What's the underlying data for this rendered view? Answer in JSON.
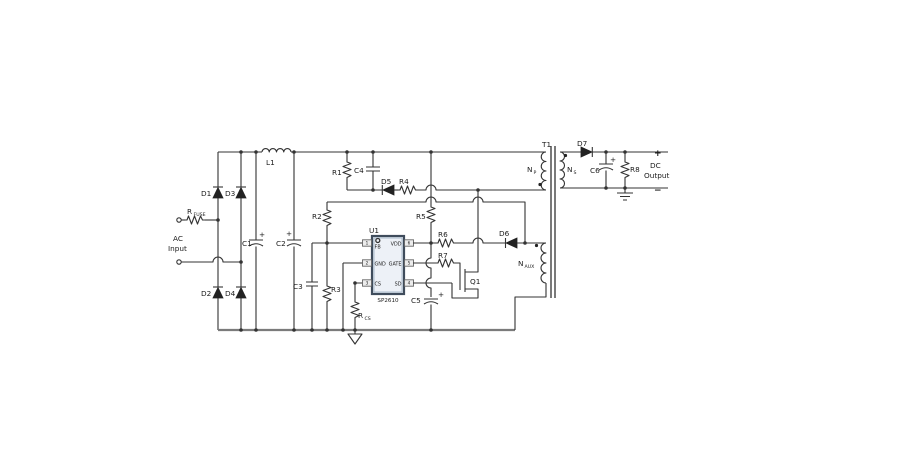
{
  "colors": {
    "wire": "#333333",
    "rail": "#7b7b7b",
    "ic_fill": "#edf1f7",
    "ic_border": "#3f4c5c",
    "pin_fill": "#ececec"
  },
  "schematic": {
    "input": {
      "ac": "AC",
      "input": "Input",
      "fuse_base": "R",
      "fuse_sub": "FUSE",
      "d1": "D1",
      "d2": "D2",
      "d3": "D3",
      "d4": "D4"
    },
    "filter": {
      "c1": "C1",
      "c2": "C2",
      "l1": "L1",
      "plus": "+"
    },
    "clamp": {
      "r1": "R1",
      "c4": "C4",
      "d5": "D5",
      "r4": "R4"
    },
    "controller": {
      "u1": "U1",
      "part": "SP2610",
      "pin_fb": "FB",
      "pin_gnd": "GND",
      "pin_cs": "CS",
      "pin_vdd": "VDD",
      "pin_gate": "GATE",
      "pin_sd": "SD",
      "n1": "1",
      "n2": "2",
      "n3": "3",
      "n4": "4",
      "n5": "5",
      "n6": "6"
    },
    "support": {
      "r2": "R2",
      "r3": "R3",
      "c3": "C3",
      "r5": "R5",
      "r6": "R6",
      "r7": "R7",
      "d6": "D6",
      "c5": "C5",
      "q1": "Q1",
      "rcs_base": "R",
      "rcs_sub": "CS",
      "plus": "+"
    },
    "transformer": {
      "t1": "T1",
      "np_base": "N",
      "np_sub": "P",
      "ns_base": "N",
      "ns_sub": "S",
      "naux_base": "N",
      "naux_sub": "AUX"
    },
    "output": {
      "d7": "D7",
      "c6": "C6",
      "r8": "R8",
      "plus": "+",
      "minus": "−",
      "dc": "DC",
      "output": "Output",
      "cap_plus": "+"
    }
  }
}
